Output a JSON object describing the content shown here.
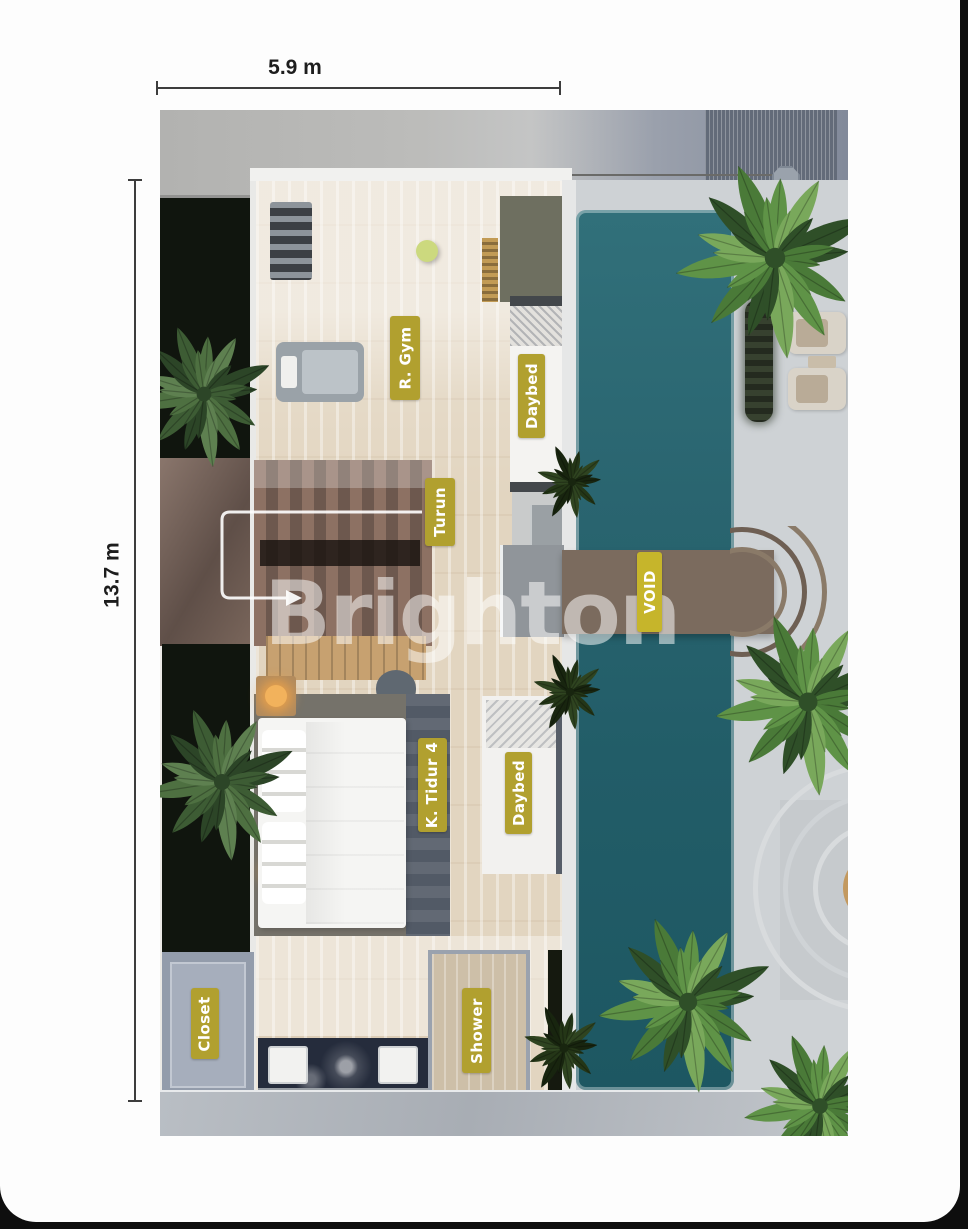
{
  "annotations": {
    "width_dimension": "5.9 m",
    "height_dimension": "13.7 m"
  },
  "watermark": {
    "text": "Brighton"
  },
  "room_labels": {
    "gym": "R. Gym",
    "daybed_upper": "Daybed",
    "stairs_down": "Turun",
    "void": "VOID",
    "bedroom": "K. Tidur 4",
    "daybed_lower": "Daybed",
    "closet": "Closet",
    "shower": "Shower"
  },
  "colors": {
    "label_gold": "#b1a02f",
    "void_gold": "#c6b52b",
    "pool_teal": "#2a6570",
    "wood_floor": "#e2d5c0",
    "planter_dark": "#10150e",
    "page_background": "#fdfdfd",
    "bezel_black": "#0e0e0e"
  }
}
